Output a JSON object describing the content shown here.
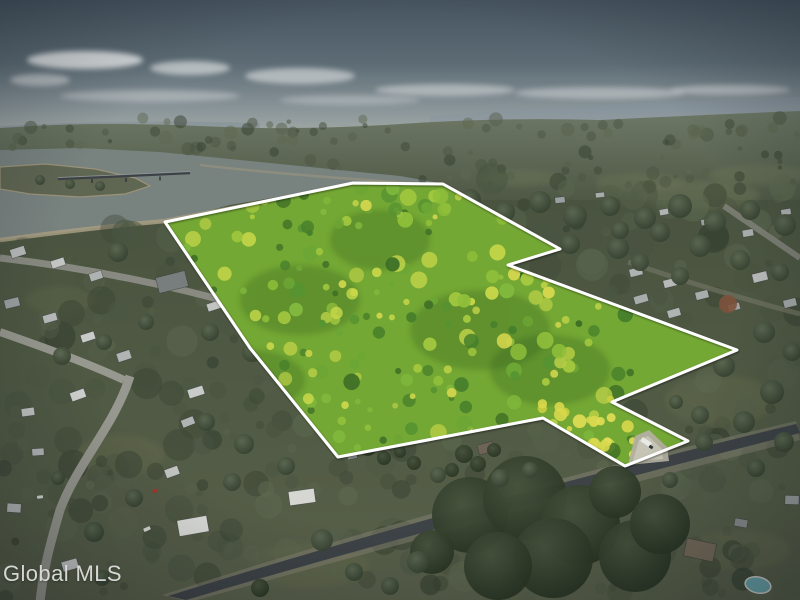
{
  "watermark": {
    "text": "Global MLS",
    "color": "#e2e3df"
  },
  "scene": {
    "kind": "aerial-drone-photo-of-land-parcel",
    "parcel_boundary": {
      "outline_color": "#ffffff",
      "points": "165,222 353,183 443,184 560,249 508,265 737,350 612,402 688,441 625,466 543,418 338,457 250,348"
    },
    "palette": {
      "sky_top": "#46545f",
      "sky_horizon": "#a7aca7",
      "distant_forest": "#49533f",
      "terrain": "#4d5741",
      "water": "#78827f",
      "shore_sand": "#a79d82",
      "parcel_base": "#74a834",
      "parcel_canopy": [
        "#8fbf3a",
        "#6ca635",
        "#b4cc45",
        "#d2d64d",
        "#569331",
        "#7fb83d",
        "#a5c93f",
        "#477f2b",
        "#c9d84a",
        "#3e6f26"
      ],
      "canopy_highlight": [
        "#d8d84c",
        "#e3de55",
        "#c9d03f"
      ],
      "ground_mottle": [
        "#3e4836",
        "#4b5642",
        "#55604a",
        "#364030",
        "#5d6850",
        "#49533f"
      ],
      "road": "#3e4347",
      "street": "#97988f",
      "pool": "#69a5aa",
      "cloud": "#eceeee"
    }
  }
}
